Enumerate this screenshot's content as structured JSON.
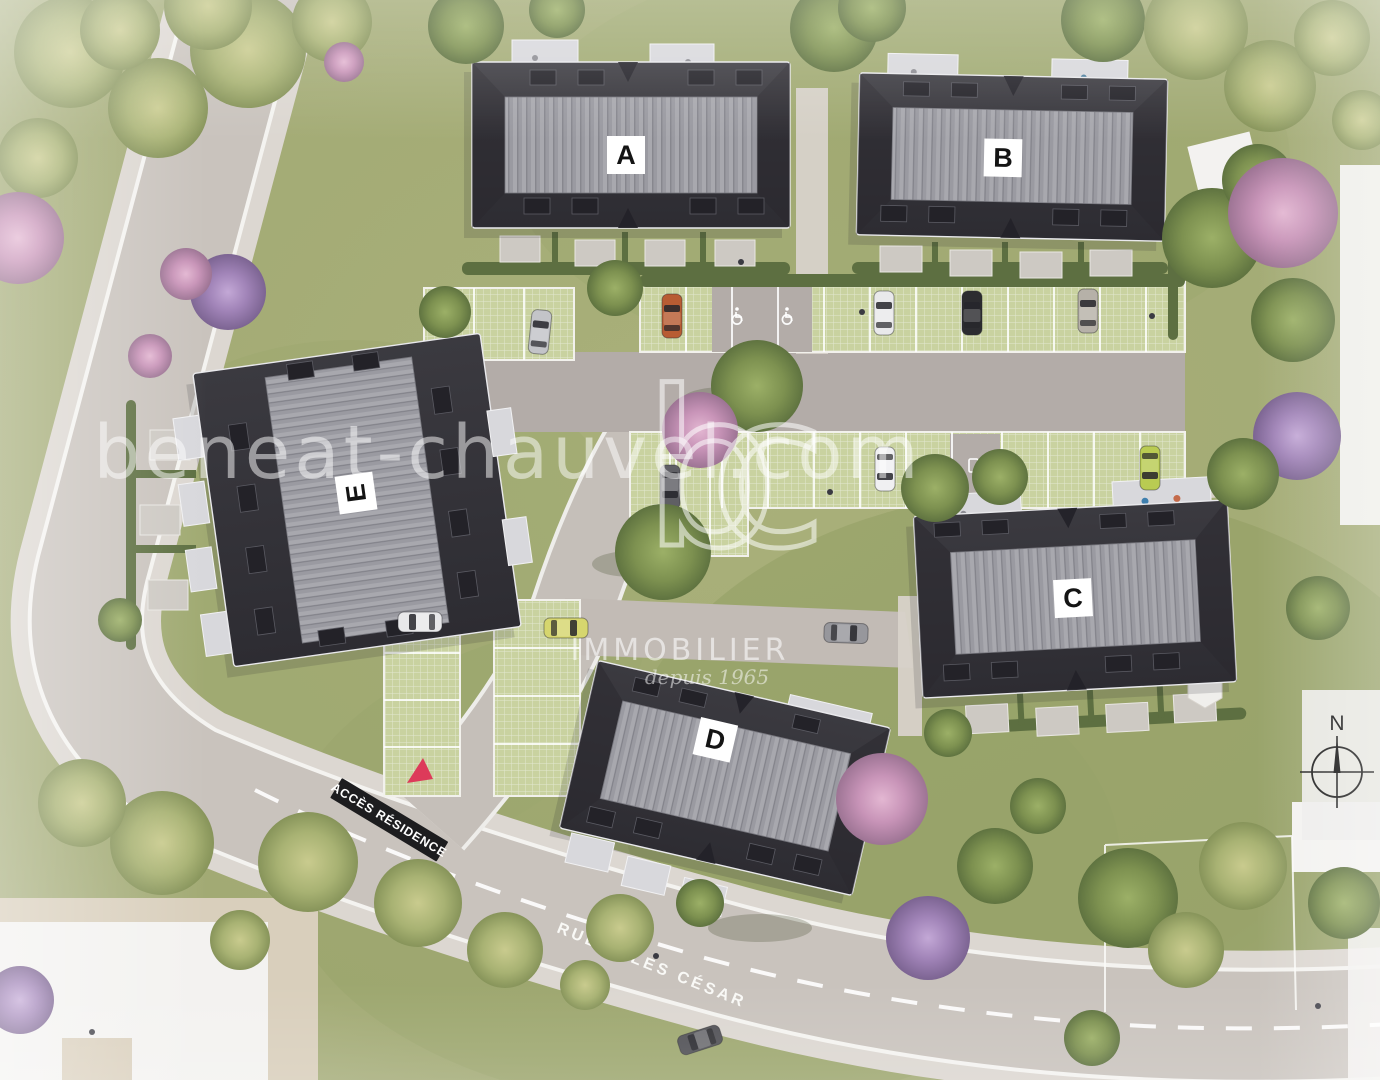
{
  "scene": {
    "type": "aerial-site-plan-render",
    "buildings": [
      {
        "id": "A",
        "label": "A"
      },
      {
        "id": "B",
        "label": "B"
      },
      {
        "id": "C",
        "label": "C"
      },
      {
        "id": "D",
        "label": "D"
      },
      {
        "id": "E",
        "label": "E"
      }
    ],
    "watermark": {
      "logo": "bc",
      "domain": "beneat-chauvel.com",
      "brand": "IMMOBILIER",
      "tagline": "depuis 1965"
    },
    "signs": {
      "access_banner": "ACCÈS RÉSIDENCE",
      "street_name": "RUE JULES CÉSAR"
    },
    "compass": {
      "north_label": "N"
    },
    "parking": {
      "handicap_space_count": 2,
      "ev_space_count": 1
    },
    "colors": {
      "roof_dark": "#35343a",
      "roof_ridge": "#9b9ba1",
      "lawn": "#a6ae7a",
      "road": "#cac4be",
      "grass_paver": "#c9d2a0",
      "sign_black": "#1d1d1f",
      "sign_red": "#dd3a5a",
      "watermark_white": "#ffffff"
    }
  }
}
